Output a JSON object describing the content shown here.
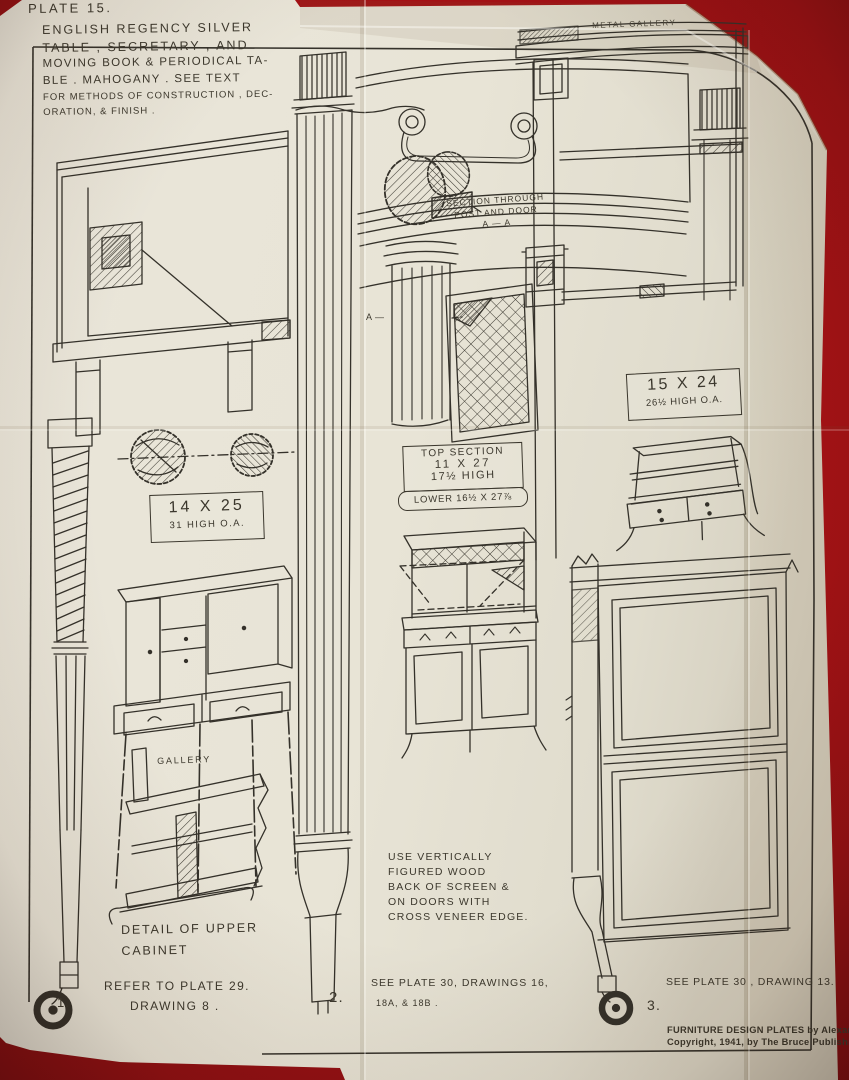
{
  "colors": {
    "background_red": "#a31115",
    "paper": "#e9e5d8",
    "ink": "#34312a"
  },
  "plate": {
    "number": "PLATE 15.",
    "title_lines": [
      "ENGLISH REGENCY SILVER",
      "TABLE , SECRETARY , AND",
      "MOVING BOOK & PERIODICAL TA-",
      "BLE . MAHOGANY .   SEE TEXT",
      "FOR METHODS OF CONSTRUCTION , DEC-",
      "ORATION, & FINISH ."
    ],
    "credit_lines": [
      "FURNITURE DESIGN PLATES by Alexander",
      "Copyright, 1941, by The Bruce Publishing"
    ]
  },
  "labels": {
    "metal_gallery": "METAL GALLERY",
    "section_note": {
      "line1": "SECTION THROUGH",
      "line2": "POST AND DOOR",
      "line3": "A — A"
    },
    "section_marker": "A —",
    "dim_left": {
      "line1": "14 X 25",
      "line2": "31 HIGH O.A."
    },
    "dim_center": {
      "line1": "TOP SECTION",
      "line2": "11 X 27",
      "line3": "17½ HIGH",
      "line4": "LOWER 16½ X 27⅞"
    },
    "dim_right": {
      "line1": "15 X 24",
      "line2": "26½ HIGH O.A."
    },
    "gallery": "GALLERY",
    "detail_caption": {
      "line1": "DETAIL OF UPPER",
      "line2": "CABINET"
    },
    "veneer_note": [
      "USE VERTICALLY",
      "FIGURED WOOD",
      "BACK OF SCREEN &",
      "ON DOORS WITH",
      "CROSS VENEER EDGE."
    ],
    "figure_refs": [
      {
        "num": "1.",
        "line1": "REFER TO PLATE 29.",
        "line2": "DRAWING 8 ."
      },
      {
        "num": "2.",
        "line1": "SEE PLATE 30, DRAWINGS 16,",
        "line2": "18A, & 18B ."
      },
      {
        "num": "3.",
        "line1": "SEE PLATE 30 , DRAWING 13."
      }
    ]
  }
}
